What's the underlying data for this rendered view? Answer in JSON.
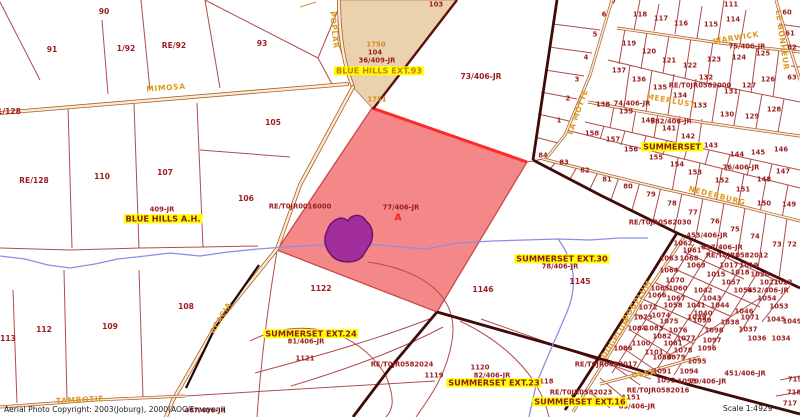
{
  "footer": {
    "copyright": "Aerial Photo Copyright:  2003(Joburg), 2000(AOC/Emoyeni)",
    "scale": "Scale 1:4929"
  },
  "map": {
    "highlight_parcel": {
      "id": "77/406-JR",
      "marker": "A",
      "fill": "#F48888"
    },
    "colors": {
      "parcel_line": "#B14B4B",
      "boundary": "#400A0A",
      "road_fill": "#F7EFC9",
      "stream": "#8C8CE6",
      "highlight_pink": "#F48888",
      "selected_purple": "#A22D9C",
      "zone_tan": "#EBD2AF",
      "label_maroon": "#9C1D1D",
      "street_orange": "#DD9A1E",
      "place_bg": "#FFFF00"
    },
    "parcel_labels": [
      {
        "t": "90",
        "x": 104,
        "y": 12,
        "cls": "lg"
      },
      {
        "t": "91",
        "x": 52,
        "y": 50,
        "cls": "lg"
      },
      {
        "t": "1/92",
        "x": 126,
        "y": 49,
        "cls": "lg"
      },
      {
        "t": "RE/92",
        "x": 174,
        "y": 46,
        "cls": "lg"
      },
      {
        "t": "93",
        "x": 262,
        "y": 44,
        "cls": "lg"
      },
      {
        "t": "103",
        "x": 436,
        "y": 5
      },
      {
        "t": "1750",
        "x": 376,
        "y": 45,
        "cls": "orange"
      },
      {
        "t": "104",
        "x": 375,
        "y": 53
      },
      {
        "t": "36/409-JR",
        "x": 377,
        "y": 61
      },
      {
        "t": "73/406-JR",
        "x": 481,
        "y": 77,
        "cls": "lg"
      },
      {
        "t": "1751",
        "x": 377,
        "y": 100,
        "cls": "orange"
      },
      {
        "t": "1/128",
        "x": 9,
        "y": 112,
        "cls": "lg"
      },
      {
        "t": "105",
        "x": 273,
        "y": 123,
        "cls": "lg"
      },
      {
        "t": "RE/128",
        "x": 34,
        "y": 181,
        "cls": "lg"
      },
      {
        "t": "110",
        "x": 102,
        "y": 177,
        "cls": "lg"
      },
      {
        "t": "107",
        "x": 165,
        "y": 173,
        "cls": "lg"
      },
      {
        "t": "106",
        "x": 246,
        "y": 199,
        "cls": "lg"
      },
      {
        "t": "409-JR",
        "x": 162,
        "y": 210
      },
      {
        "t": "RE/T0JR0016000",
        "x": 300,
        "y": 207
      },
      {
        "t": "77/406-JR",
        "x": 401,
        "y": 208
      },
      {
        "t": "A",
        "x": 398,
        "y": 218,
        "cls": "red"
      },
      {
        "t": "1122",
        "x": 321,
        "y": 289,
        "cls": "lg"
      },
      {
        "t": "1146",
        "x": 483,
        "y": 290,
        "cls": "lg"
      },
      {
        "t": "78/406-JR",
        "x": 560,
        "y": 267
      },
      {
        "t": "1145",
        "x": 580,
        "y": 282,
        "cls": "lg"
      },
      {
        "t": "112",
        "x": 44,
        "y": 330,
        "cls": "lg"
      },
      {
        "t": "113",
        "x": 8,
        "y": 339,
        "cls": "lg"
      },
      {
        "t": "109",
        "x": 110,
        "y": 327,
        "cls": "lg"
      },
      {
        "t": "108",
        "x": 186,
        "y": 307,
        "cls": "lg"
      },
      {
        "t": "81/406-JR",
        "x": 306,
        "y": 342
      },
      {
        "t": "1121",
        "x": 305,
        "y": 359
      },
      {
        "t": "RE/T0JR0582024",
        "x": 402,
        "y": 365
      },
      {
        "t": "1119",
        "x": 434,
        "y": 376
      },
      {
        "t": "1120",
        "x": 480,
        "y": 368
      },
      {
        "t": "82/406-JR",
        "x": 492,
        "y": 376
      },
      {
        "t": "1118",
        "x": 544,
        "y": 382
      },
      {
        "t": "RE/T0JR0582023",
        "x": 581,
        "y": 393
      },
      {
        "t": "1151",
        "x": 631,
        "y": 398
      },
      {
        "t": "83/406-JR",
        "x": 637,
        "y": 407
      },
      {
        "t": "RE/T0JR0582017",
        "x": 606,
        "y": 365
      },
      {
        "t": "RE/T0JR0582016",
        "x": 658,
        "y": 391
      },
      {
        "t": "79/406-JR",
        "x": 708,
        "y": 382
      },
      {
        "t": "451/406-JR",
        "x": 745,
        "y": 374
      },
      {
        "t": "467/406-JR",
        "x": 205,
        "y": 411
      },
      {
        "t": "7",
        "x": 614,
        "y": 2
      },
      {
        "t": "6",
        "x": 604,
        "y": 15
      },
      {
        "t": "5",
        "x": 595,
        "y": 35
      },
      {
        "t": "4",
        "x": 586,
        "y": 58
      },
      {
        "t": "3",
        "x": 577,
        "y": 80
      },
      {
        "t": "2",
        "x": 568,
        "y": 99
      },
      {
        "t": "1",
        "x": 559,
        "y": 121
      },
      {
        "t": "118",
        "x": 640,
        "y": 15
      },
      {
        "t": "117",
        "x": 661,
        "y": 19
      },
      {
        "t": "116",
        "x": 681,
        "y": 24
      },
      {
        "t": "115",
        "x": 711,
        "y": 25
      },
      {
        "t": "114",
        "x": 733,
        "y": 20
      },
      {
        "t": "111",
        "x": 731,
        "y": 5
      },
      {
        "t": "60",
        "x": 787,
        "y": 13
      },
      {
        "t": "61",
        "x": 790,
        "y": 34
      },
      {
        "t": "62",
        "x": 792,
        "y": 48
      },
      {
        "t": "63",
        "x": 792,
        "y": 78
      },
      {
        "t": "119",
        "x": 629,
        "y": 44
      },
      {
        "t": "120",
        "x": 649,
        "y": 52
      },
      {
        "t": "121",
        "x": 669,
        "y": 61
      },
      {
        "t": "122",
        "x": 690,
        "y": 66
      },
      {
        "t": "123",
        "x": 714,
        "y": 60
      },
      {
        "t": "124",
        "x": 739,
        "y": 58
      },
      {
        "t": "125",
        "x": 763,
        "y": 54
      },
      {
        "t": "75/406-JR",
        "x": 747,
        "y": 47
      },
      {
        "t": "137",
        "x": 619,
        "y": 71
      },
      {
        "t": "136",
        "x": 639,
        "y": 80
      },
      {
        "t": "135",
        "x": 660,
        "y": 88
      },
      {
        "t": "134",
        "x": 680,
        "y": 96
      },
      {
        "t": "133",
        "x": 700,
        "y": 106
      },
      {
        "t": "132",
        "x": 706,
        "y": 78
      },
      {
        "t": "RE/T0JR0582000",
        "x": 700,
        "y": 86
      },
      {
        "t": "131",
        "x": 731,
        "y": 92
      },
      {
        "t": "127",
        "x": 749,
        "y": 86
      },
      {
        "t": "126",
        "x": 768,
        "y": 80
      },
      {
        "t": "128",
        "x": 774,
        "y": 110
      },
      {
        "t": "129",
        "x": 752,
        "y": 117
      },
      {
        "t": "130",
        "x": 727,
        "y": 115
      },
      {
        "t": "74/406-JR",
        "x": 632,
        "y": 104
      },
      {
        "t": "138",
        "x": 603,
        "y": 105
      },
      {
        "t": "139",
        "x": 626,
        "y": 112
      },
      {
        "t": "140",
        "x": 648,
        "y": 121
      },
      {
        "t": "582/406-JR",
        "x": 671,
        "y": 122
      },
      {
        "t": "141",
        "x": 669,
        "y": 129
      },
      {
        "t": "142",
        "x": 688,
        "y": 137
      },
      {
        "t": "158",
        "x": 592,
        "y": 134
      },
      {
        "t": "157",
        "x": 613,
        "y": 140
      },
      {
        "t": "156",
        "x": 631,
        "y": 150
      },
      {
        "t": "155",
        "x": 656,
        "y": 158
      },
      {
        "t": "154",
        "x": 677,
        "y": 165
      },
      {
        "t": "153",
        "x": 695,
        "y": 173
      },
      {
        "t": "152",
        "x": 722,
        "y": 181
      },
      {
        "t": "151",
        "x": 743,
        "y": 190
      },
      {
        "t": "143",
        "x": 711,
        "y": 146
      },
      {
        "t": "144",
        "x": 737,
        "y": 155
      },
      {
        "t": "145",
        "x": 758,
        "y": 153
      },
      {
        "t": "146",
        "x": 781,
        "y": 150
      },
      {
        "t": "147",
        "x": 783,
        "y": 172
      },
      {
        "t": "148",
        "x": 764,
        "y": 180
      },
      {
        "t": "150",
        "x": 764,
        "y": 204
      },
      {
        "t": "149",
        "x": 789,
        "y": 205
      },
      {
        "t": "76/406-JR",
        "x": 741,
        "y": 168
      },
      {
        "t": "84",
        "x": 543,
        "y": 156
      },
      {
        "t": "83",
        "x": 564,
        "y": 163
      },
      {
        "t": "82",
        "x": 585,
        "y": 171
      },
      {
        "t": "81",
        "x": 607,
        "y": 180
      },
      {
        "t": "80",
        "x": 628,
        "y": 187
      },
      {
        "t": "79",
        "x": 651,
        "y": 195
      },
      {
        "t": "78",
        "x": 672,
        "y": 204
      },
      {
        "t": "77",
        "x": 693,
        "y": 213
      },
      {
        "t": "76",
        "x": 715,
        "y": 222
      },
      {
        "t": "75",
        "x": 735,
        "y": 230
      },
      {
        "t": "74",
        "x": 755,
        "y": 237
      },
      {
        "t": "73",
        "x": 777,
        "y": 245
      },
      {
        "t": "72",
        "x": 792,
        "y": 245
      },
      {
        "t": "RE/T0JR0582030",
        "x": 660,
        "y": 223
      },
      {
        "t": "453/406-JR",
        "x": 707,
        "y": 236
      },
      {
        "t": "637/406-JR",
        "x": 722,
        "y": 248
      },
      {
        "t": "RE/T0JR0582012",
        "x": 737,
        "y": 256
      },
      {
        "t": "1062",
        "x": 683,
        "y": 244
      },
      {
        "t": "1061",
        "x": 692,
        "y": 251
      },
      {
        "t": "1063",
        "x": 669,
        "y": 259
      },
      {
        "t": "1068",
        "x": 689,
        "y": 259
      },
      {
        "t": "1069",
        "x": 696,
        "y": 266
      },
      {
        "t": "1017",
        "x": 729,
        "y": 266
      },
      {
        "t": "1019",
        "x": 749,
        "y": 266
      },
      {
        "t": "1015",
        "x": 716,
        "y": 275
      },
      {
        "t": "1018",
        "x": 740,
        "y": 273
      },
      {
        "t": "1020",
        "x": 760,
        "y": 275
      },
      {
        "t": "1064",
        "x": 669,
        "y": 271
      },
      {
        "t": "1070",
        "x": 675,
        "y": 281
      },
      {
        "t": "1057",
        "x": 731,
        "y": 283
      },
      {
        "t": "1021",
        "x": 769,
        "y": 283
      },
      {
        "t": "1022",
        "x": 783,
        "y": 283
      },
      {
        "t": "1065",
        "x": 660,
        "y": 289
      },
      {
        "t": "1060",
        "x": 678,
        "y": 289
      },
      {
        "t": "1042",
        "x": 703,
        "y": 291
      },
      {
        "t": "1056",
        "x": 743,
        "y": 291
      },
      {
        "t": "452/406-JR",
        "x": 768,
        "y": 291
      },
      {
        "t": "1066",
        "x": 657,
        "y": 296
      },
      {
        "t": "1067",
        "x": 676,
        "y": 299
      },
      {
        "t": "1043",
        "x": 712,
        "y": 299
      },
      {
        "t": "1044",
        "x": 720,
        "y": 306
      },
      {
        "t": "1054",
        "x": 767,
        "y": 299
      },
      {
        "t": "1053",
        "x": 779,
        "y": 307
      },
      {
        "t": "1058",
        "x": 673,
        "y": 306
      },
      {
        "t": "1041",
        "x": 696,
        "y": 306
      },
      {
        "t": "1040",
        "x": 703,
        "y": 314
      },
      {
        "t": "1046",
        "x": 744,
        "y": 312
      },
      {
        "t": "1045",
        "x": 776,
        "y": 320
      },
      {
        "t": "1049",
        "x": 792,
        "y": 322
      },
      {
        "t": "1072",
        "x": 648,
        "y": 308
      },
      {
        "t": "1073",
        "x": 643,
        "y": 318
      },
      {
        "t": "1074",
        "x": 661,
        "y": 316
      },
      {
        "t": "1075",
        "x": 669,
        "y": 322
      },
      {
        "t": "1039",
        "x": 697,
        "y": 318
      },
      {
        "t": "1038",
        "x": 730,
        "y": 323
      },
      {
        "t": "1071",
        "x": 750,
        "y": 318
      },
      {
        "t": "1037",
        "x": 748,
        "y": 330
      },
      {
        "t": "1036",
        "x": 757,
        "y": 339
      },
      {
        "t": "1034",
        "x": 781,
        "y": 339
      },
      {
        "t": "1084",
        "x": 637,
        "y": 329
      },
      {
        "t": "1083",
        "x": 654,
        "y": 329
      },
      {
        "t": "1076",
        "x": 678,
        "y": 331
      },
      {
        "t": "1099",
        "x": 702,
        "y": 321
      },
      {
        "t": "1098",
        "x": 714,
        "y": 331
      },
      {
        "t": "1082",
        "x": 662,
        "y": 337
      },
      {
        "t": "1077",
        "x": 686,
        "y": 339
      },
      {
        "t": "1097",
        "x": 712,
        "y": 341
      },
      {
        "t": "1100",
        "x": 641,
        "y": 344
      },
      {
        "t": "1081",
        "x": 673,
        "y": 344
      },
      {
        "t": "1086",
        "x": 623,
        "y": 349
      },
      {
        "t": "1101",
        "x": 654,
        "y": 353
      },
      {
        "t": "1078",
        "x": 683,
        "y": 351
      },
      {
        "t": "1096",
        "x": 707,
        "y": 349
      },
      {
        "t": "1080",
        "x": 662,
        "y": 358
      },
      {
        "t": "1079",
        "x": 676,
        "y": 358
      },
      {
        "t": "1095",
        "x": 697,
        "y": 362
      },
      {
        "t": "1091",
        "x": 662,
        "y": 372
      },
      {
        "t": "1094",
        "x": 689,
        "y": 372
      },
      {
        "t": "1092",
        "x": 666,
        "y": 381
      },
      {
        "t": "1093",
        "x": 687,
        "y": 382
      },
      {
        "t": "719",
        "x": 795,
        "y": 380
      },
      {
        "t": "718",
        "x": 794,
        "y": 393
      },
      {
        "t": "717",
        "x": 790,
        "y": 404
      }
    ],
    "street_labels": [
      {
        "t": "MIMOSA",
        "x": 166,
        "y": 88,
        "r": -4
      },
      {
        "t": "POPLAR",
        "x": 334,
        "y": 30,
        "r": 84
      },
      {
        "t": "ACACIA",
        "x": 221,
        "y": 318,
        "r": -59
      },
      {
        "t": "TAMBOTIE",
        "x": 80,
        "y": 400,
        "r": -3
      },
      {
        "t": "LA MOTTE",
        "x": 578,
        "y": 112,
        "r": -70
      },
      {
        "t": "WARWICK",
        "x": 736,
        "y": 38,
        "r": -9
      },
      {
        "t": "LE BONHEUR",
        "x": 782,
        "y": 40,
        "r": 82
      },
      {
        "t": "MEERLUST",
        "x": 671,
        "y": 101,
        "r": 10
      },
      {
        "t": "NEDERBURG",
        "x": 717,
        "y": 196,
        "r": 14
      },
      {
        "t": "DOGPLUM",
        "x": 616,
        "y": 338,
        "r": -57
      },
      {
        "t": "DOGPLUM",
        "x": 637,
        "y": 301,
        "r": -57
      },
      {
        "t": "OLEA",
        "x": 644,
        "y": 374,
        "r": -8
      }
    ],
    "place_labels": [
      {
        "t": "BLUE HILLS EXT.93",
        "x": 379,
        "y": 71,
        "cls": "ext93"
      },
      {
        "t": "BLUE HILLS A.H.",
        "x": 163,
        "y": 219
      },
      {
        "t": "SUMMERSET",
        "x": 672,
        "y": 147
      },
      {
        "t": "SUMMERSET EXT.30",
        "x": 562,
        "y": 259
      },
      {
        "t": "SUMMERSET EXT.24",
        "x": 311,
        "y": 334
      },
      {
        "t": "SUMMERSET EXT.23",
        "x": 494,
        "y": 383
      },
      {
        "t": "SUMMERSET EXT.16",
        "x": 580,
        "y": 402
      }
    ]
  }
}
